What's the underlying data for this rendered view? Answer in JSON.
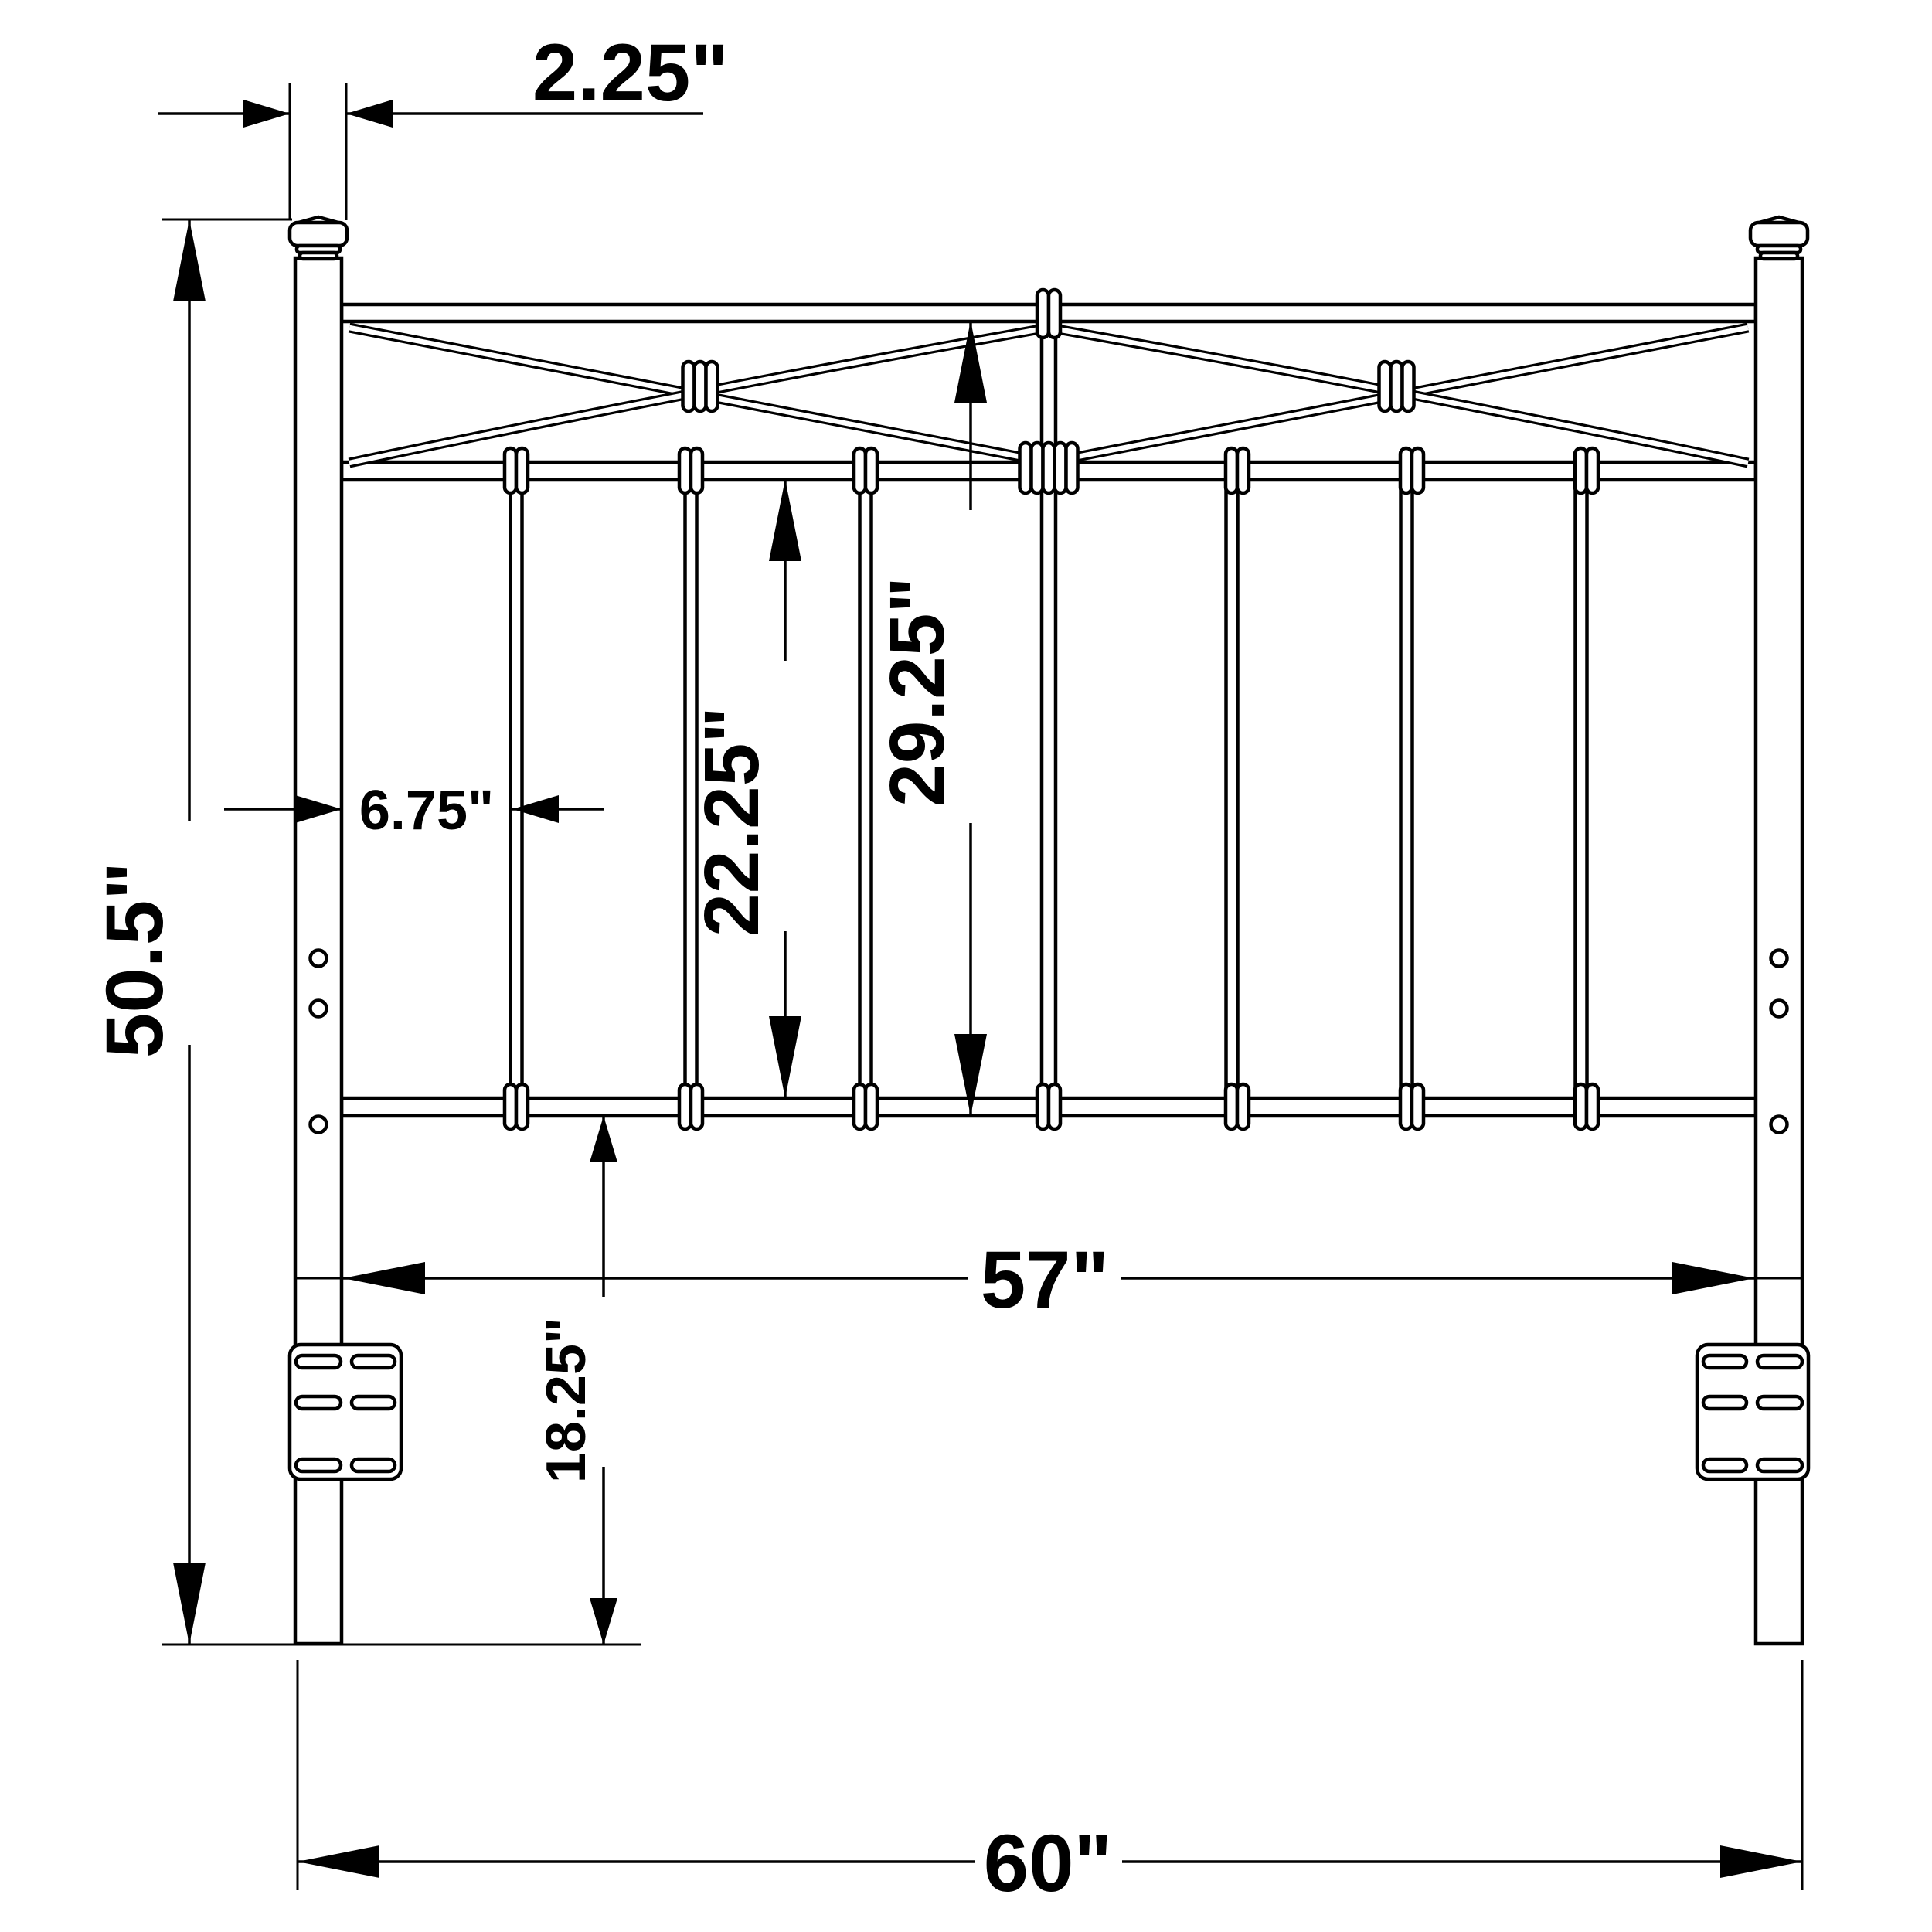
{
  "colors": {
    "line": "#000000",
    "background": "#ffffff"
  },
  "labels": {
    "post_width": "2.25\"",
    "overall_height": "50.5\"",
    "post_to_first_spindle": "6.75\"",
    "spindle_section_height": "22.25\"",
    "grille_height": "29.25\"",
    "between_posts_width": "57\"",
    "leg_height": "18.25\"",
    "overall_width": "60\""
  }
}
